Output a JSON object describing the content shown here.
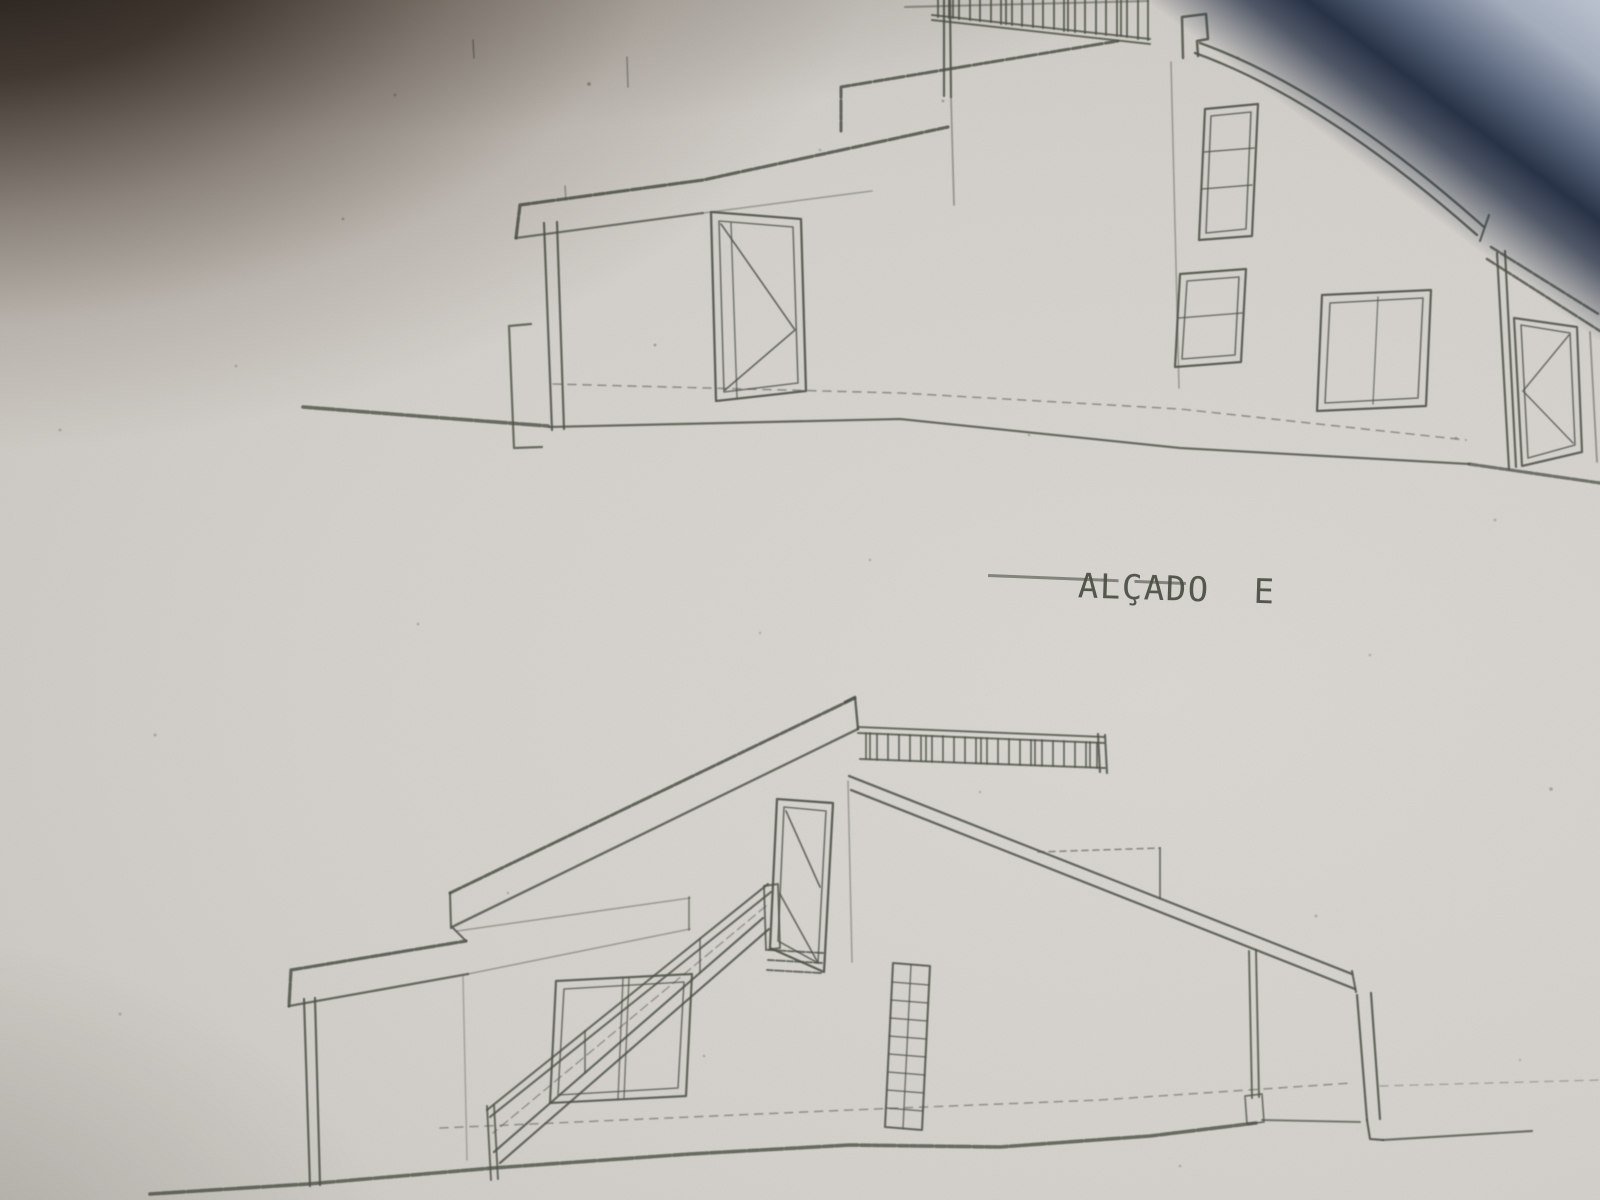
{
  "photo": {
    "kind": "photographed pencil architectural drawing",
    "label": {
      "title": "ALÇADO  E"
    },
    "colors": {
      "paper": "#d6d3ce",
      "pencil": "#4c5146",
      "corner_shadow": "#2b1f16",
      "blue_edge_dark": "#2e3c58",
      "blue_edge_light": "#bac1ce"
    },
    "drawings": {
      "top_elevation": {
        "name": "upper house elevation sketch",
        "elements": [
          "sloped roof fascia",
          "upper parapet line",
          "roof terrace railing with balusters",
          "chimney block",
          "curved roof edge",
          "gable corner line",
          "left wall with footing",
          "entry door with diagonal bracing",
          "tall three-pane window",
          "small two-pane window",
          "wide two-pane window",
          "right corner post",
          "annex roof edge",
          "annex door with diagonal bracing",
          "sloping ground line",
          "dashed floor line"
        ]
      },
      "bottom_elevation": {
        "name": "lower house elevation sketch",
        "elements": [
          "long mono-pitch roof band",
          "eave fascia",
          "ridge railing with balusters",
          "rear roof slope with step",
          "upper-level door with diagonal bracing",
          "external staircase with handrail and newel posts",
          "two-pane window behind stairs",
          "lattice grid panel",
          "support post with footing",
          "right wall with ground step",
          "sloping ground line",
          "dashed floor line"
        ]
      }
    }
  }
}
